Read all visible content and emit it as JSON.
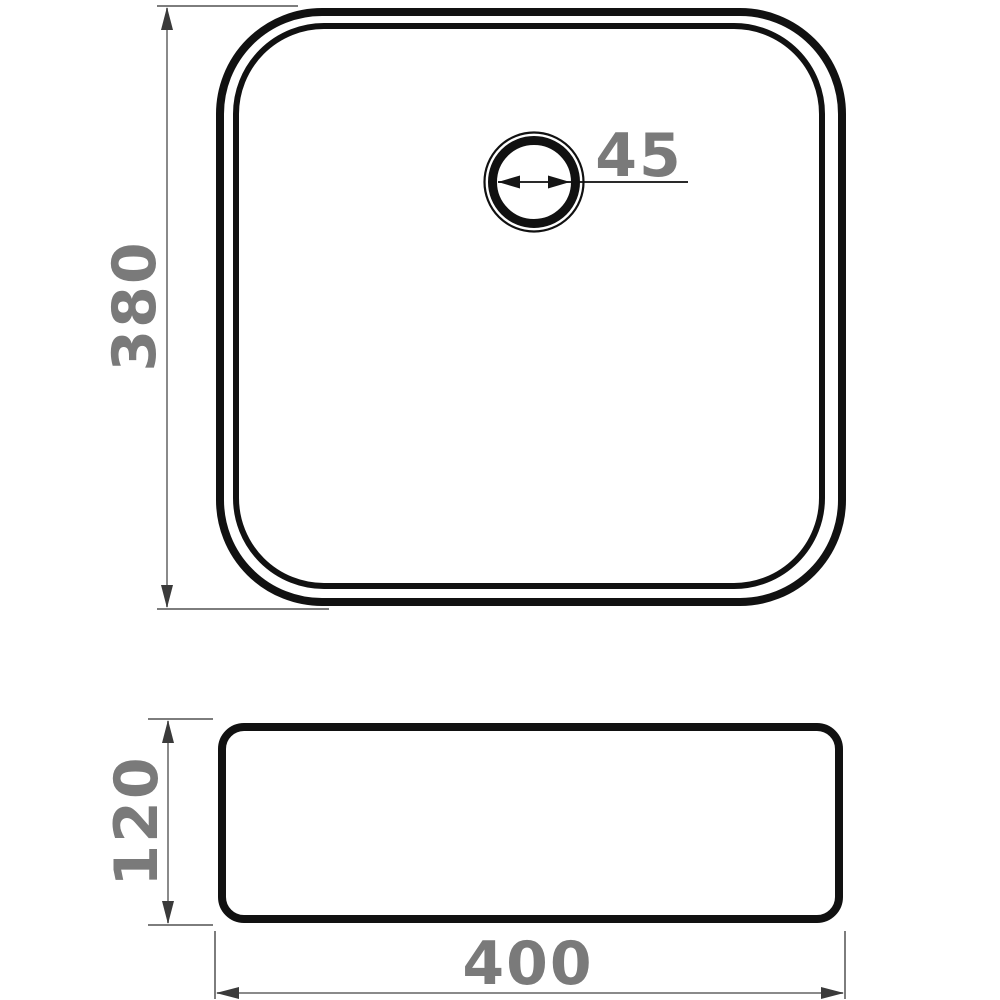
{
  "diagram": {
    "views": {
      "top": {
        "label": "top-view",
        "height_dimension": "380",
        "drain_diameter": "45"
      },
      "side": {
        "label": "side-view",
        "height_dimension": "120",
        "width_dimension": "400"
      }
    },
    "colors": {
      "outline": "#111111",
      "dimension_line": "#8a8a8a",
      "extension_line": "#7d7d7d",
      "leader_line": "#2a2a2a",
      "arrowhead": "#3a3a3a",
      "dimension_text": "#7a7a7a",
      "background": "#ffffff"
    }
  }
}
